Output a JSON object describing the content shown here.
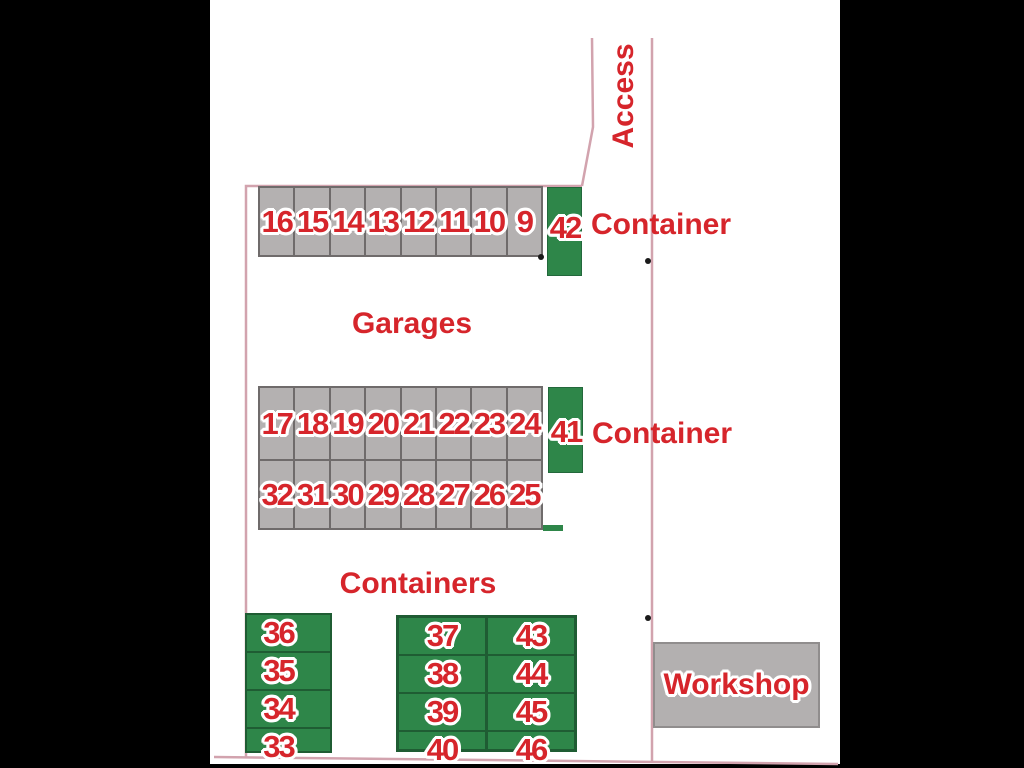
{
  "plan": {
    "labels": {
      "access": "Access",
      "garages": "Garages",
      "containers": "Containers",
      "container_top": "Container",
      "container_mid": "Container",
      "workshop": "Workshop"
    },
    "garage_row_top": [
      "16",
      "15",
      "14",
      "13",
      "12",
      "11",
      "10",
      "9"
    ],
    "garage_mid_front": [
      "17",
      "18",
      "19",
      "20",
      "21",
      "22",
      "23",
      "24"
    ],
    "garage_mid_back": [
      "32",
      "31",
      "30",
      "29",
      "28",
      "27",
      "26",
      "25"
    ],
    "container_top_num": "42",
    "container_mid_num": "41",
    "containers_left": [
      "36",
      "35",
      "34",
      "33"
    ],
    "containers_mid": [
      "37",
      "38",
      "39",
      "40"
    ],
    "containers_right": [
      "43",
      "44",
      "45",
      "46"
    ],
    "colors": {
      "red": "#d6252b",
      "green": "#2e8649",
      "green_dark": "#1f5c33",
      "gray": "#b4b1b1",
      "gray_dark": "#6f6b6b",
      "pink": "#d2a3ae",
      "workshop_gray": "#b3b0b0"
    }
  }
}
